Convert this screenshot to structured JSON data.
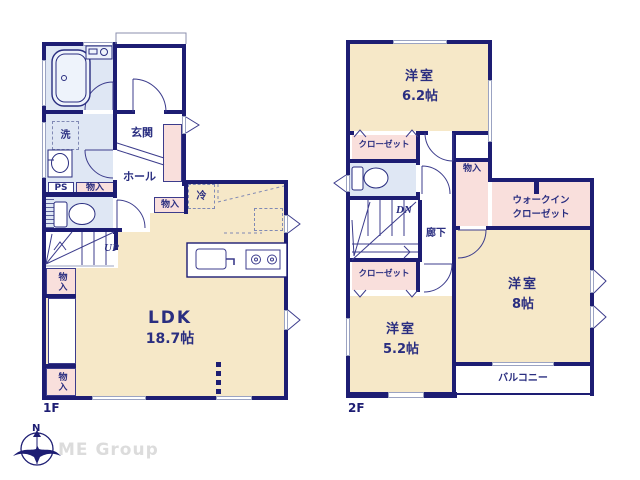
{
  "colors": {
    "wall_navy": "#1d1d73",
    "room_cream": "#f6e8c8",
    "room_blue": "#dfe7f4",
    "room_pink": "#f9dfdc",
    "window_gray": "#9ba3c2",
    "label_navy": "#2a2e80",
    "logo_gray": "#dcdcdc"
  },
  "floor1": {
    "label": "1F",
    "ldk_name": "LDK",
    "ldk_size": "18.7帖",
    "genkan": "玄関",
    "hall": "ホール",
    "washer": "洗",
    "ps": "PS",
    "storage": "物入",
    "fridge": "冷",
    "stairs_up": "UP"
  },
  "floor2": {
    "label": "2F",
    "room1_name": "洋室",
    "room1_size": "6.2帖",
    "room2_name": "洋室",
    "room2_size": "8帖",
    "room3_name": "洋室",
    "room3_size": "5.2帖",
    "closet": "クローゼット",
    "wic_line1": "ウォークイン",
    "wic_line2": "クローゼット",
    "storage": "物入",
    "corridor": "廊下",
    "stairs_down": "DN",
    "balcony": "バルコニー"
  },
  "logo": {
    "company": "ME Group",
    "compass_north": "N"
  }
}
